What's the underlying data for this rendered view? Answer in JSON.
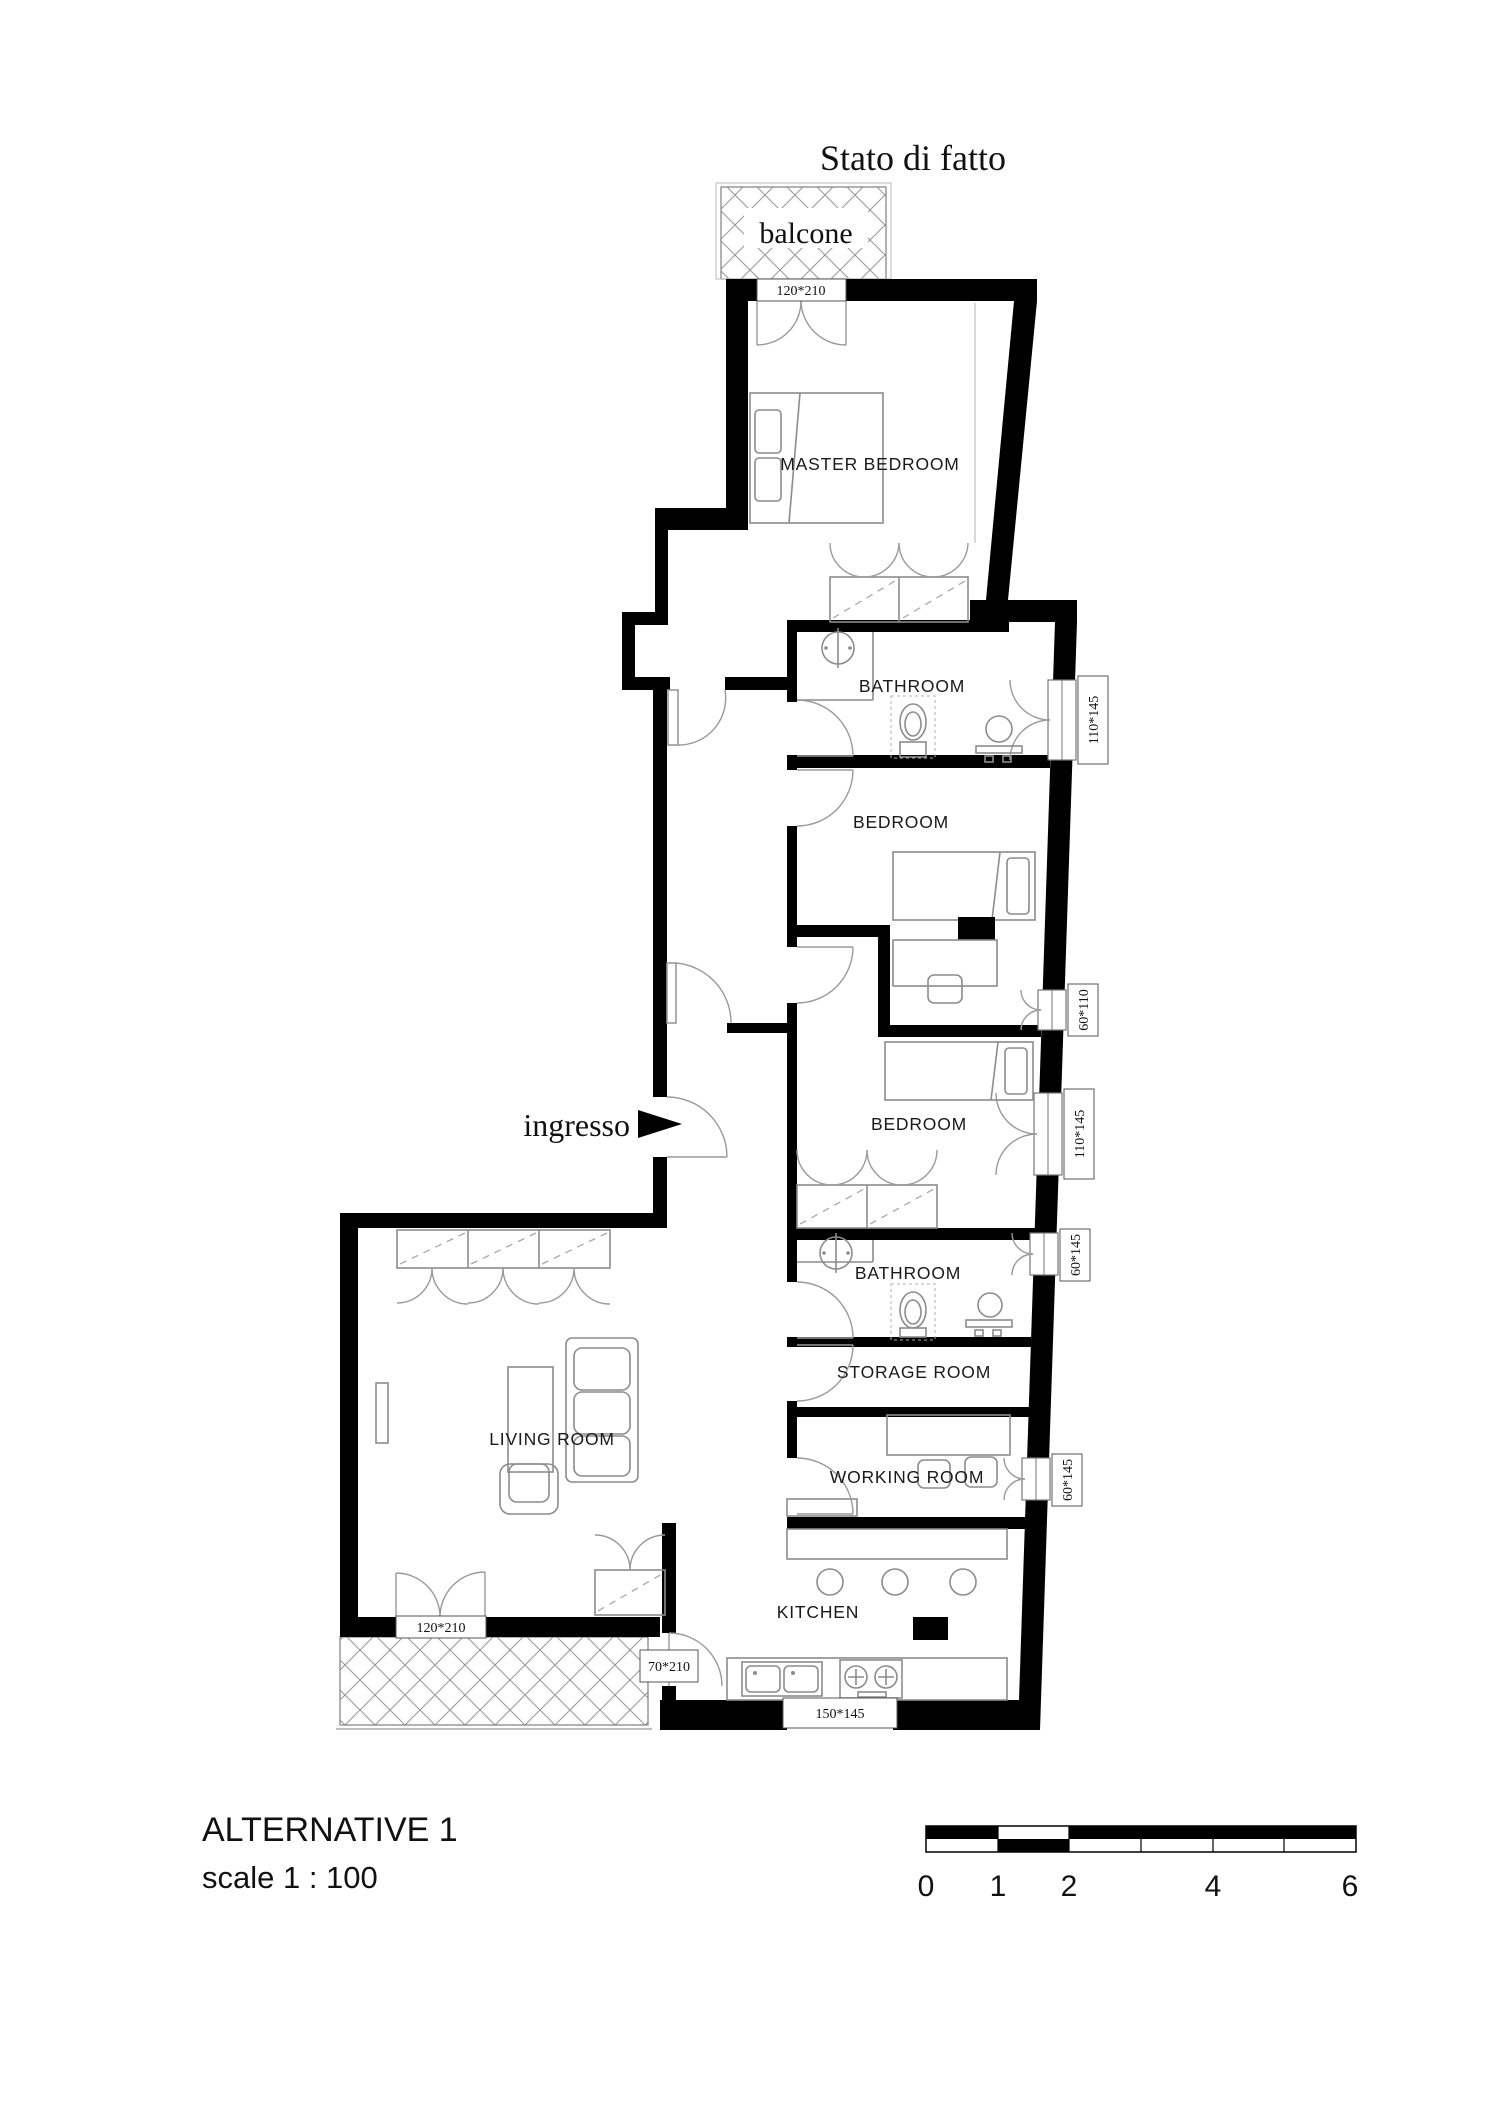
{
  "title": "Stato di fatto",
  "plan": {
    "balcony_top_label": "balcone",
    "entrance_label": "ingresso",
    "rooms": {
      "master_bedroom": "MASTER BEDROOM",
      "bathroom_1": "BATHROOM",
      "bedroom_1": "BEDROOM",
      "bedroom_2": "BEDROOM",
      "bathroom_2": "BATHROOM",
      "storage_room": "STORAGE ROOM",
      "working_room": "WORKING ROOM",
      "kitchen": "KITCHEN",
      "living_room": "LIVING ROOM"
    },
    "openings": {
      "master_balcony_door": "120*210",
      "bathroom_1_window": "110*145",
      "bedroom_1_window": "60*110",
      "bedroom_2_window": "110*145",
      "bathroom_2_window": "60*145",
      "working_room_window": "60*145",
      "kitchen_window": "150*145",
      "kitchen_balcony_door": "70*210",
      "living_room_balcony_door": "120*210"
    }
  },
  "footer": {
    "variant": "ALTERNATIVE 1",
    "scale": "scale  1 : 100",
    "scalebar_ticks": [
      "0",
      "1",
      "2",
      "4",
      "6"
    ]
  },
  "colors": {
    "wall": "#000000",
    "furniture": "#8c8c8c",
    "background": "#ffffff"
  }
}
